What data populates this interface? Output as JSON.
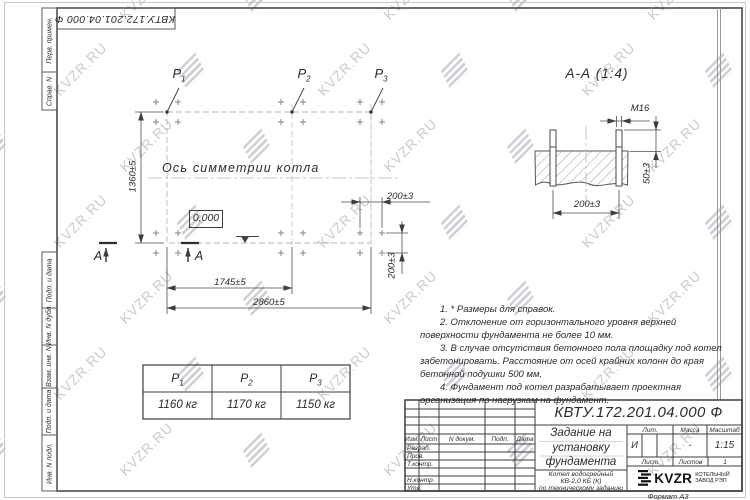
{
  "watermark": {
    "text": "KVZR.RU"
  },
  "sheet": {
    "designation_top": "КВТУ.172.201.04.000  Ф",
    "format_label": "Формат А3",
    "margin_top_labels": [
      "Перв. примен.",
      "Справ. N"
    ],
    "margin_bottom_labels": [
      "Подп. и дата",
      "Инв. N дубл.",
      "Взам. инв. N",
      "Подп. и дата",
      "Инв. N подл."
    ]
  },
  "plan": {
    "axis_label": "Ось симметрии котла",
    "level_mark": "0,000",
    "points": [
      {
        "base": "P",
        "sub": "1"
      },
      {
        "base": "P",
        "sub": "2"
      },
      {
        "base": "P",
        "sub": "3"
      }
    ],
    "section_letter_left": "А",
    "section_letter_right": "А",
    "dim_height": "1360±5",
    "dim_width_inner": "1745±5",
    "dim_width_total": "2860±5",
    "dim_bolt_x": "200±3",
    "dim_bolt_y": "200±3"
  },
  "section_view": {
    "title": "А-А (1:4)",
    "thread_label": "М16",
    "dim_width": "200±3",
    "dim_height": "50±3"
  },
  "notes": [
    "1. * Размеры для справок.",
    "2. Отклонение от горизонтального уровня верхней поверхности фундамента не более 10 мм.",
    "3. В случае отсутствия бетонного пола площадку под котел забетонировать. Расстояние от осей крайних колонн до края бетонной подушки 500 мм.",
    "4. Фундамент под котел разрабатывает проектная организация по нагрузкам на фундамент."
  ],
  "load_table": {
    "headers": [
      {
        "base": "P",
        "sub": "1"
      },
      {
        "base": "P",
        "sub": "2"
      },
      {
        "base": "P",
        "sub": "3"
      }
    ],
    "values": [
      "1160 кг",
      "1170 кг",
      "1150 кг"
    ]
  },
  "title_block": {
    "designation": "КВТУ.172.201.04.000  Ф",
    "title_lines": [
      "Задание на",
      "установку",
      "фундамента"
    ],
    "product_lines": [
      "Котел водогрейный",
      "КВ-2,0 КБ (К)",
      "по техническому заданию"
    ],
    "header_cols": [
      "Изм.",
      "Лист",
      "N докум.",
      "Подп.",
      "Дата"
    ],
    "row_labels": [
      "Разраб.",
      "Пров.",
      "Т.контр.",
      "",
      "Н.контр.",
      "Утв."
    ],
    "lit_label": "Лит.",
    "mass_label": "Масса",
    "scale_label": "Масштаб",
    "lit_value": "И",
    "mass_value": "-",
    "scale_value": "1:15",
    "sheet_label": "Лист",
    "sheets_label": "Листов",
    "sheets_value": "1",
    "logo_text": "KVZR",
    "logo_sub": [
      "КОТЕЛЬНЫЙ",
      "ЗАВОД РЭП"
    ]
  }
}
